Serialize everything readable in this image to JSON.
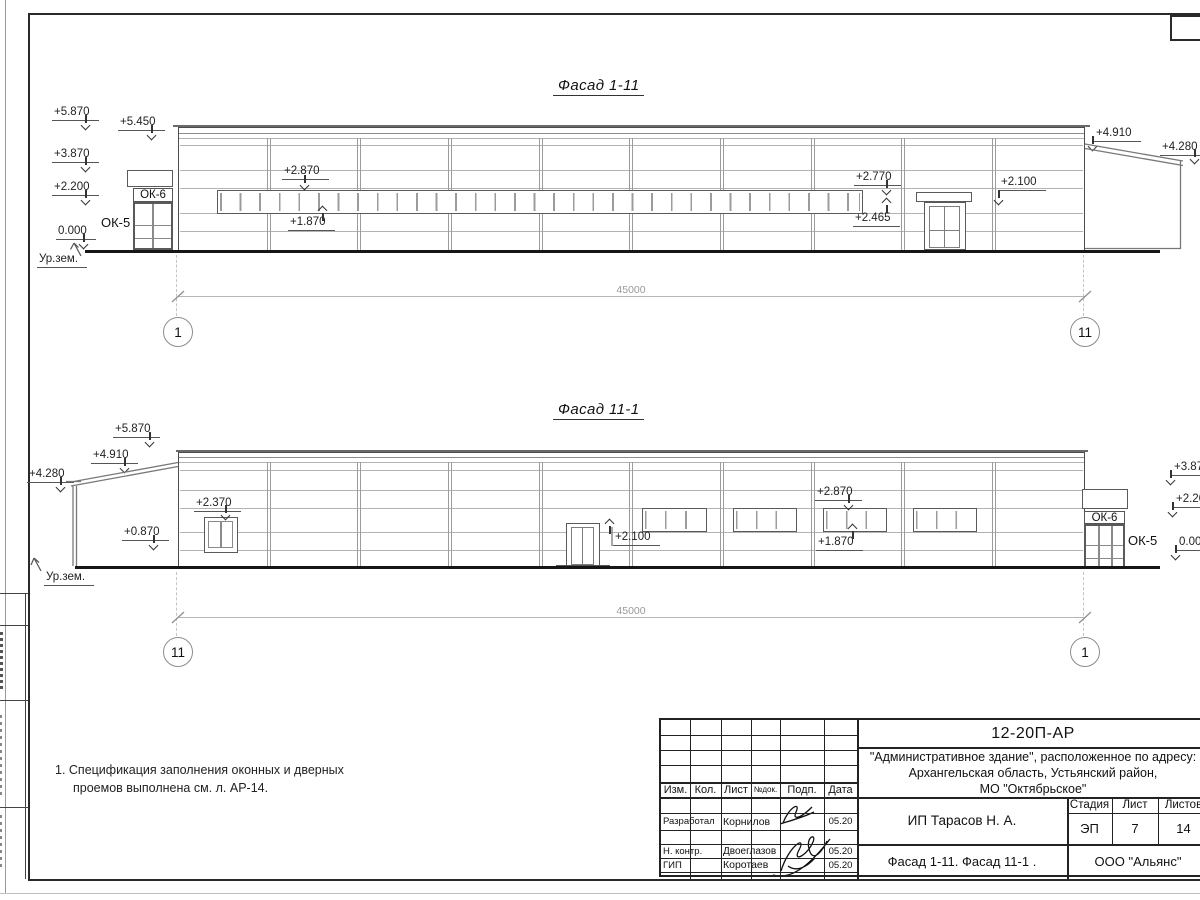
{
  "facade1": {
    "title": "Фасад 1-11",
    "dim": "45000",
    "axis_left": "1",
    "axis_right": "11",
    "ok6": "ОК-6",
    "ok5": "ОК-5",
    "ground_label": "Ур.зем.",
    "elev": {
      "e5870": "+5.870",
      "e5450": "+5.450",
      "e3870": "+3.870",
      "e2200": "+2.200",
      "e0000": "0.000",
      "band_top": "+2.870",
      "band_bot": "+1.870",
      "e2770": "+2.770",
      "e2465": "+2.465",
      "e2100": "+2.100",
      "e4910": "+4.910",
      "e4280": "+4.280"
    }
  },
  "facade2": {
    "title": "Фасад 11-1",
    "dim": "45000",
    "axis_left": "11",
    "axis_right": "1",
    "ok6": "ОК-6",
    "ok5": "ОК-5",
    "ground_label": "Ур.зем.",
    "elev": {
      "e5870": "+5.870",
      "e4910": "+4.910",
      "e4280": "+4.280",
      "e2370": "+2.370",
      "e0870": "+0.870",
      "e2100": "+2.100",
      "band_top": "+2.870",
      "band_bot": "+1.870",
      "r3870": "+3.870",
      "r2200": "+2.200",
      "r0000": "0.000"
    }
  },
  "notes": {
    "line1": "1. Спецификация заполнения оконных и дверных",
    "line2": "проемов выполнена см. л. АР-14."
  },
  "titleblock": {
    "doc_number": "12-20П-АР",
    "project_line1": "\"Административное здание\", расположенное по адресу:",
    "project_line2": "Архангельская область, Устьянский район,",
    "project_line3": "МО \"Октябрьское\"",
    "client": "ИП Тарасов Н. А.",
    "drawing_title": "Фасад 1-11. Фасад 11-1 .",
    "company": "ООО \"Альянс\"",
    "col_izm": "Изм.",
    "col_kol": "Кол.",
    "col_list": "Лист",
    "col_ndok": "№док.",
    "col_podp": "Подп.",
    "col_data": "Дата",
    "stage_label": "Стадия",
    "sheet_label": "Лист",
    "sheets_label": "Листов",
    "stage": "ЭП",
    "sheet": "7",
    "sheets": "14",
    "rows": [
      {
        "role": "Разработал",
        "name": "Корнилов",
        "date": "05.20"
      },
      {
        "role": "Н. контр.",
        "name": "Двоеглазов",
        "date": "05.20"
      },
      {
        "role": "ГИП",
        "name": "Коротаев",
        "date": "05.20"
      }
    ]
  }
}
